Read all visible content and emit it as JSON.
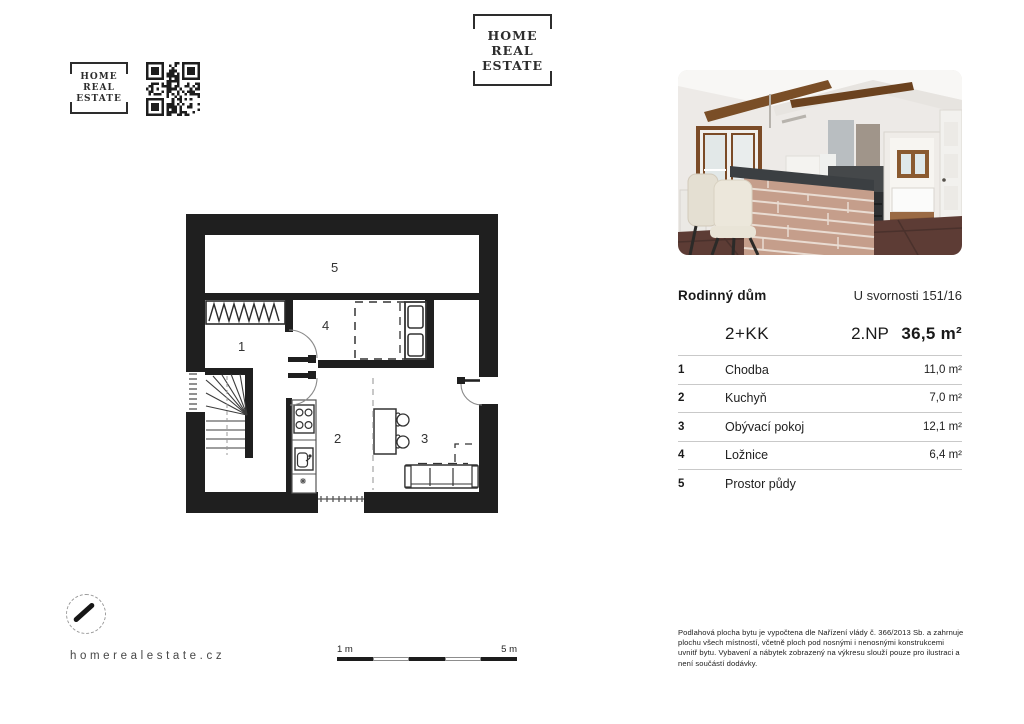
{
  "brand": {
    "logo": {
      "line1": "HOME",
      "line2": "REAL",
      "line3": "ESTATE"
    },
    "website": "homerealestate.cz"
  },
  "listing": {
    "property_type": "Rodinný dům",
    "address": "U svornosti 151/16",
    "layout": "2+KK",
    "floor": "2.NP",
    "total_area": "36,5 m²"
  },
  "rooms": [
    {
      "num": "1",
      "name": "Chodba",
      "area": "11,0 m²"
    },
    {
      "num": "2",
      "name": "Kuchyň",
      "area": "7,0 m²"
    },
    {
      "num": "3",
      "name": "Obývací pokoj",
      "area": "12,1 m²"
    },
    {
      "num": "4",
      "name": "Ložnice",
      "area": "6,4 m²"
    },
    {
      "num": "5",
      "name": "Prostor půdy",
      "area": ""
    }
  ],
  "scale_bar": {
    "start_label": "1 m",
    "end_label": "5 m"
  },
  "disclaimer": "Podlahová plocha bytu je vypočtena dle Nařízení vlády č. 366/2013 Sb. a zahrnuje plochu všech místností, včetně ploch pod nosnými i nenosnými konstrukcemi uvnitř bytu. Vybavení a nábytek zobrazený na výkresu slouží pouze pro ilustraci a není součástí dodávky.",
  "colors": {
    "wall": "#1f1f1f",
    "line": "#c9c9c9"
  }
}
